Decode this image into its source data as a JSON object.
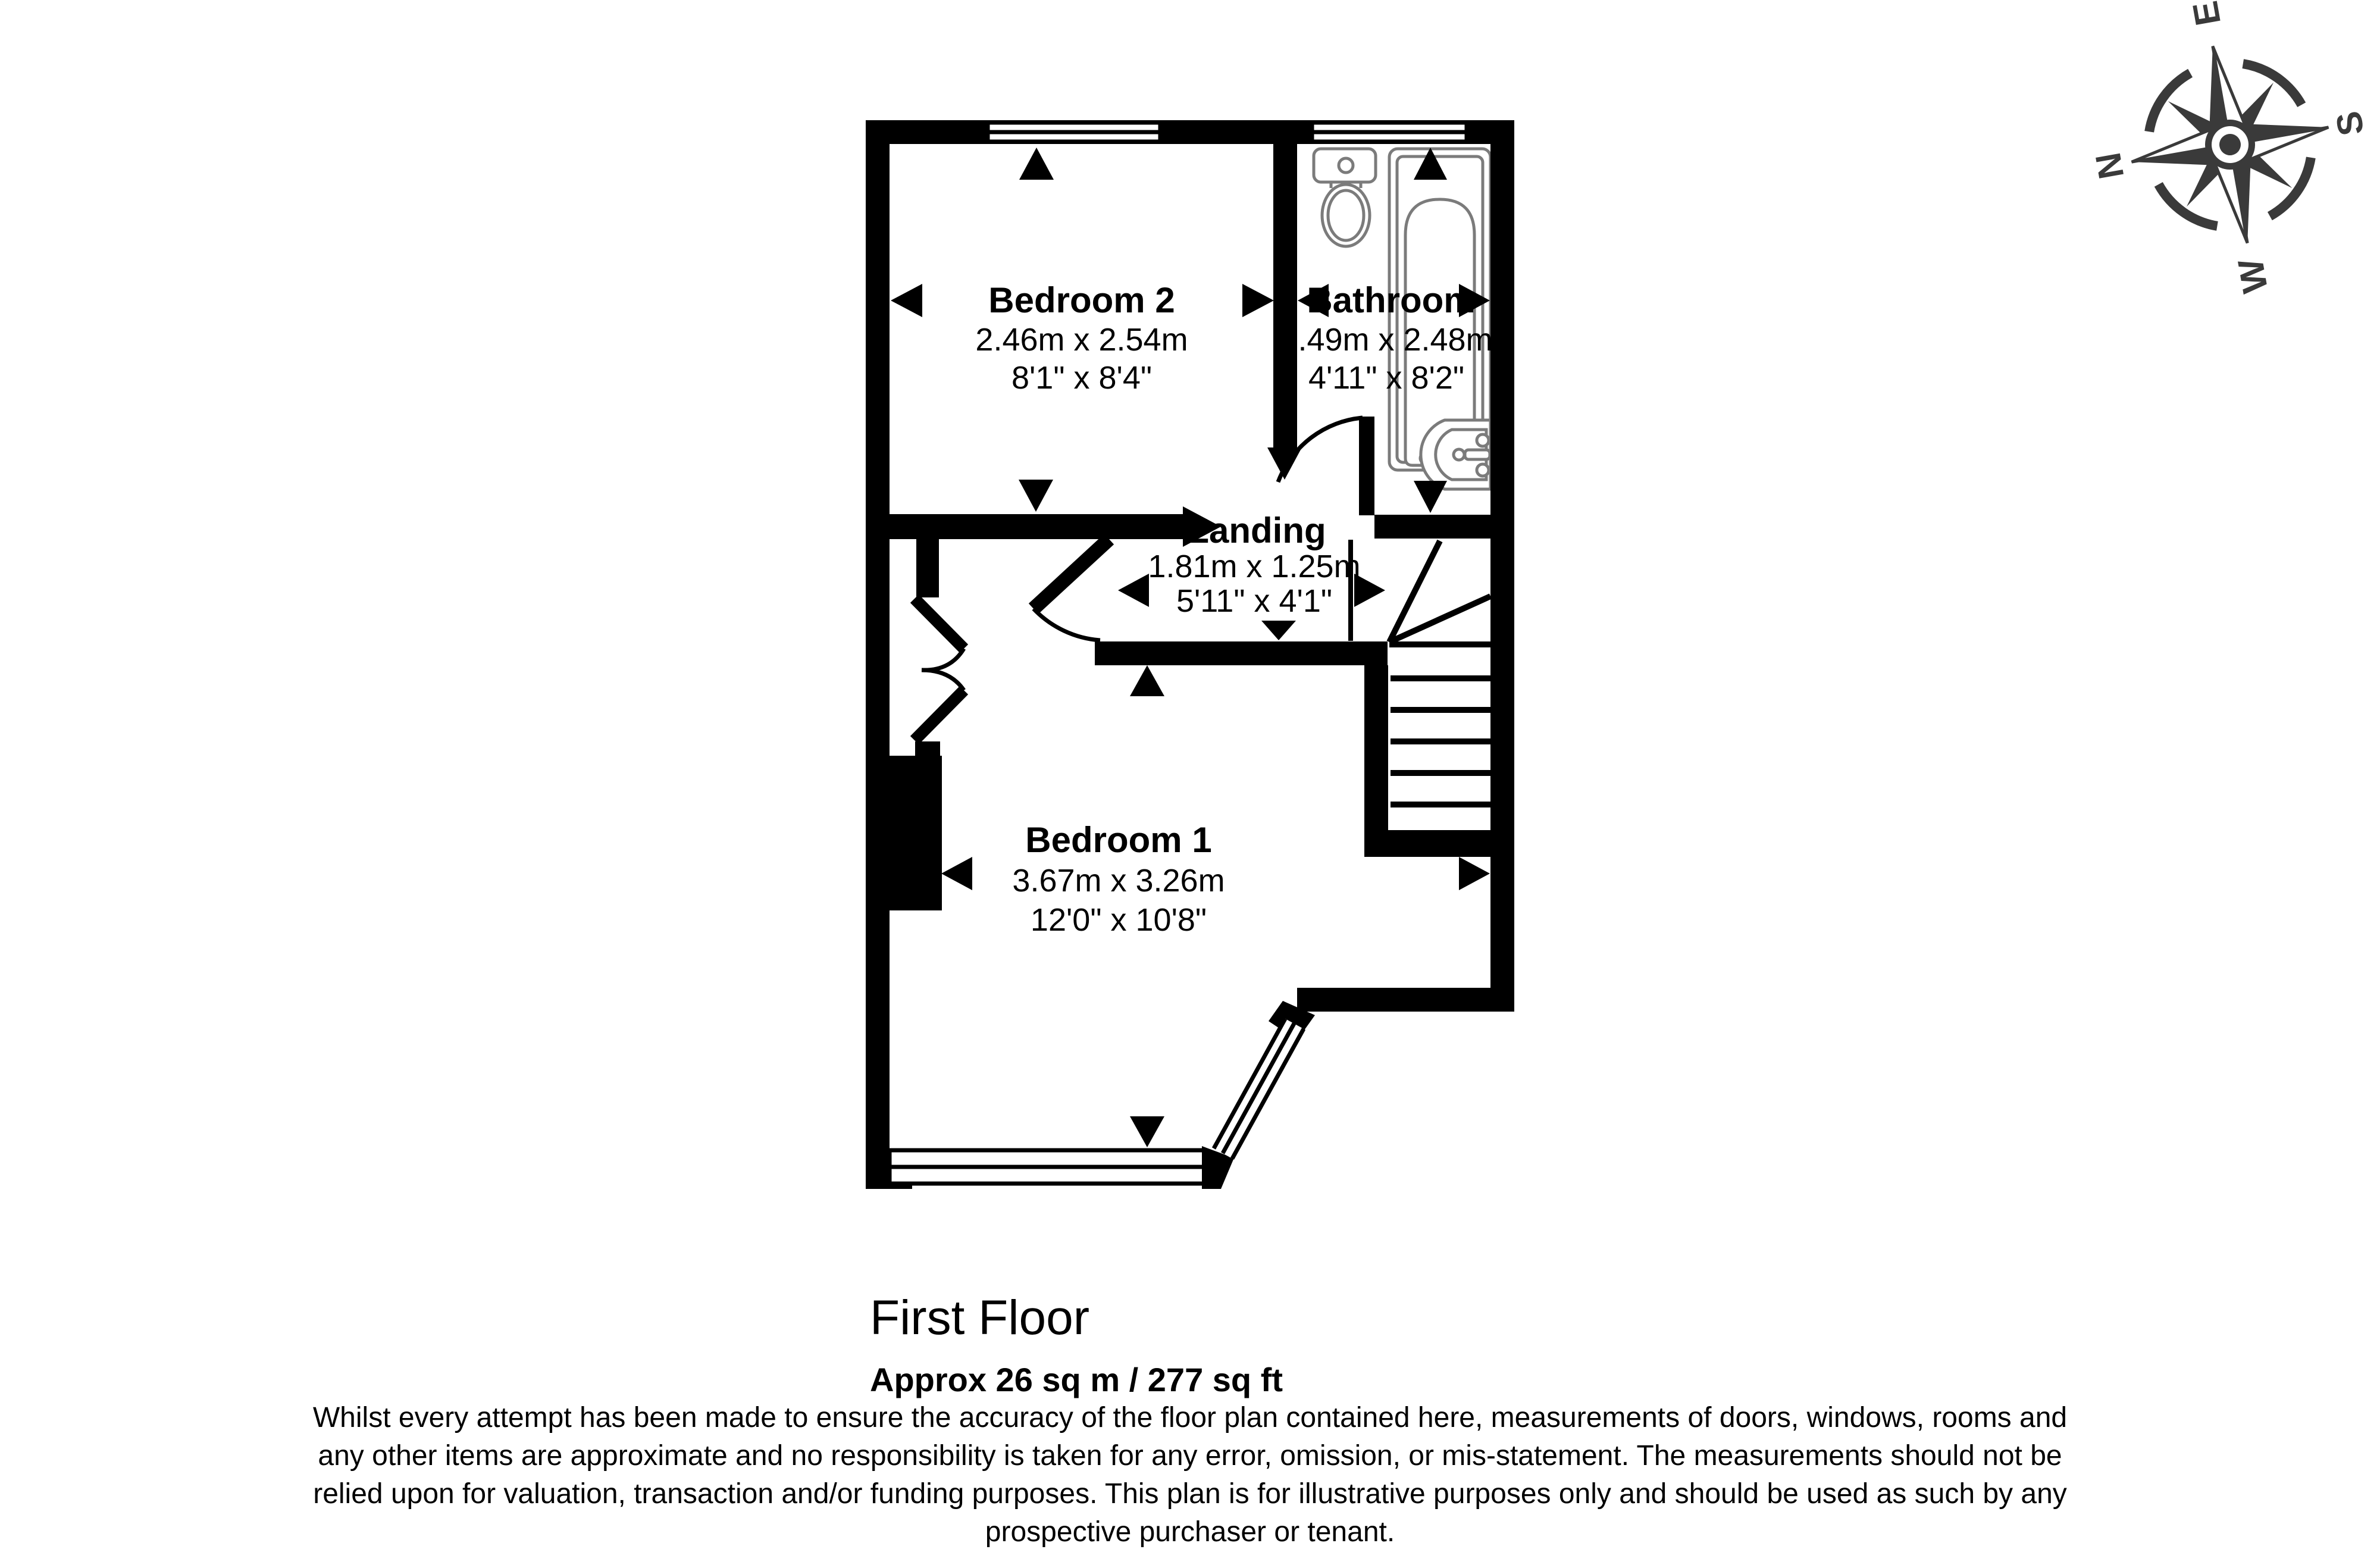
{
  "plan": {
    "rooms": [
      {
        "name": "Bedroom 2",
        "metric": "2.46m x 2.54m",
        "imperial": "8'1\" x 8'4\""
      },
      {
        "name": "Bathroom",
        "metric": "1.49m x 2.48m",
        "imperial": "4'11\" x 8'2\""
      },
      {
        "name": "Landing",
        "metric": "1.81m x 1.25m",
        "imperial": "5'11\" x 4'1\""
      },
      {
        "name": "Bedroom 1",
        "metric": "3.67m x 3.26m",
        "imperial": "12'0\" x 10'8\""
      }
    ],
    "floor_title": "First Floor",
    "floor_area": "Approx 26 sq m / 277 sq ft",
    "disclaimer_lines": [
      "Whilst every attempt has been made to ensure the accuracy of the floor plan contained here, measurements of doors, windows, rooms and",
      "any other items are approximate and no responsibility is taken for any error, omission, or mis-statement. The measurements should not be",
      "relied upon for valuation, transaction and/or funding purposes. This plan is for illustrative purposes only and should be used as such by any",
      "prospective purchaser or tenant."
    ],
    "compass": {
      "north": "N",
      "east": "E",
      "south": "S",
      "west": "W"
    },
    "colors": {
      "wall": "#000000",
      "fixture_outline": "#7b7b7b",
      "compass": "#3a3a3a",
      "text": "#000000",
      "background": "#ffffff"
    }
  }
}
